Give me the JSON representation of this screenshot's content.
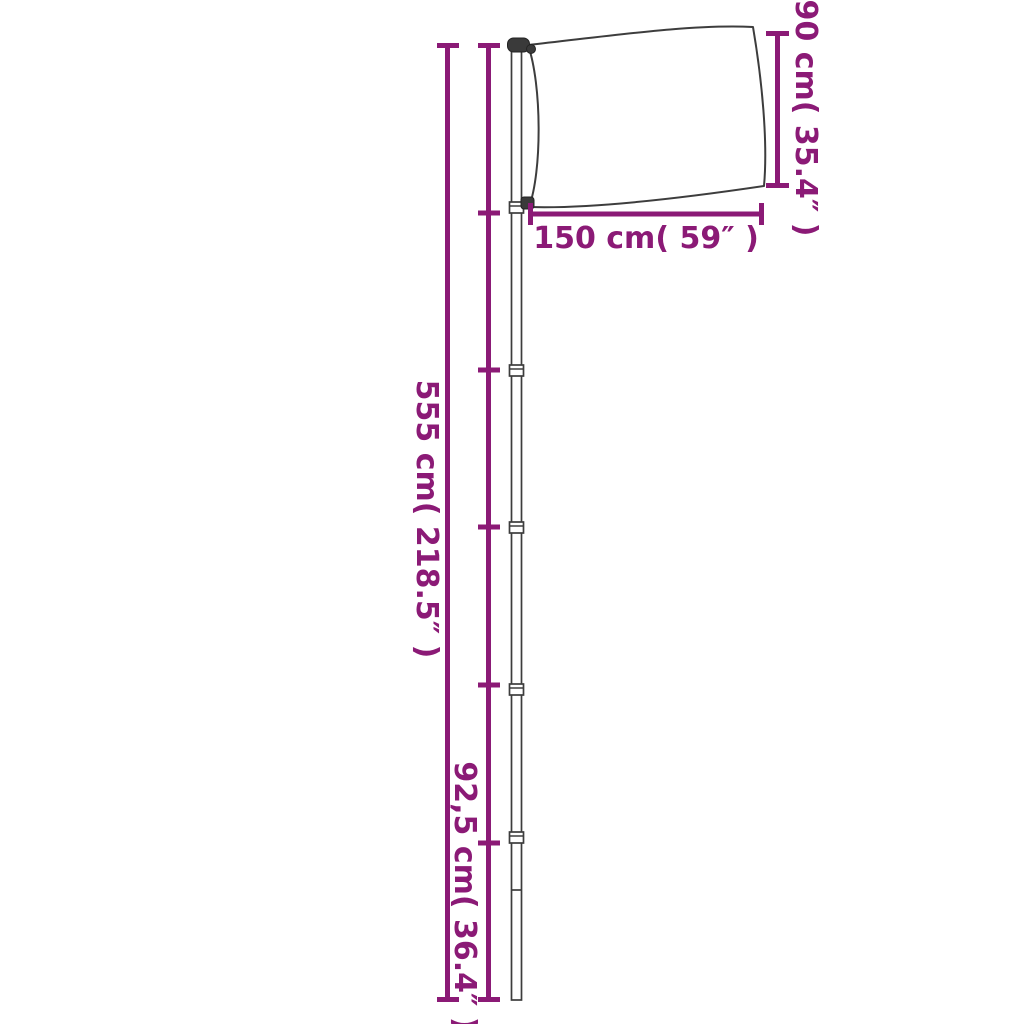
{
  "diagram": {
    "labels": {
      "flag_height": "90 cm( 35.4″ )",
      "flag_width": "150 cm( 59″ )",
      "pole_height": "555 cm( 218.5″ )",
      "segment_length": "92,5 cm( 36.4″ )"
    },
    "colors": {
      "accent": "#8B1A76",
      "outline": "#3D3D3D",
      "background": "#FFFFFF"
    }
  }
}
